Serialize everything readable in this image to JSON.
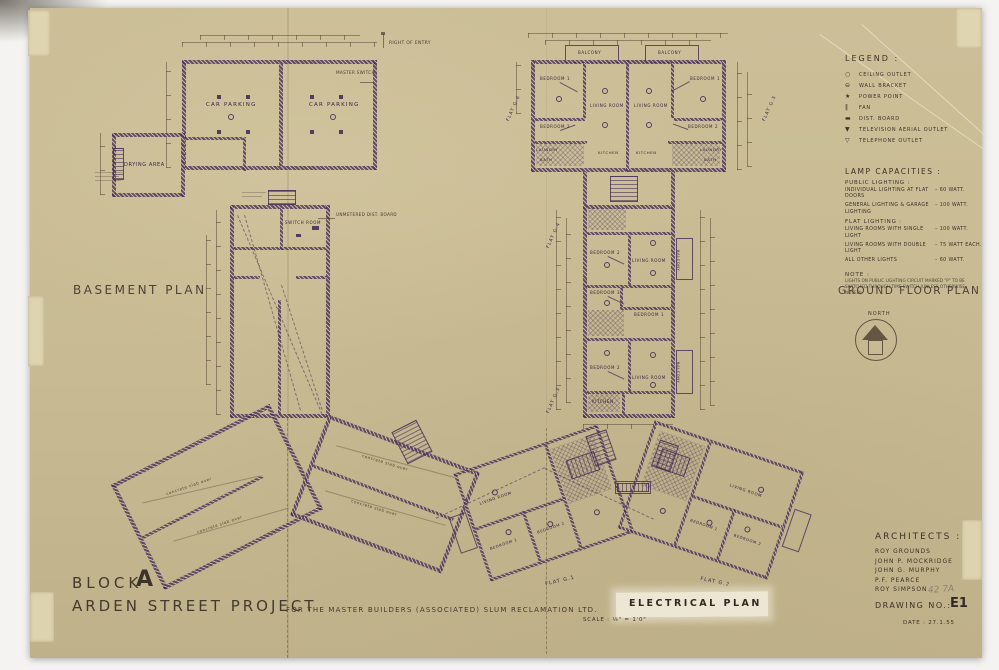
{
  "titles": {
    "basement": "BASEMENT PLAN",
    "ground": "GROUND FLOOR PLAN",
    "north": "NORTH"
  },
  "legend": {
    "title": "LEGEND :",
    "items": [
      {
        "name": "ceiling-outlet",
        "glyph": "○",
        "label": "CEILING OUTLET"
      },
      {
        "name": "wall-bracket",
        "glyph": "⊖",
        "label": "WALL BRACKET"
      },
      {
        "name": "power-point",
        "glyph": "★",
        "label": "POWER POINT"
      },
      {
        "name": "fan",
        "glyph": "‖",
        "label": "FAN"
      },
      {
        "name": "dist-board",
        "glyph": "▬",
        "label": "DIST. BOARD"
      },
      {
        "name": "television-aerial-outlet",
        "glyph": "▼",
        "label": "TELEVISION AERIAL OUTLET"
      },
      {
        "name": "telephone-outlet",
        "glyph": "▽",
        "label": "TELEPHONE OUTLET"
      }
    ]
  },
  "lamp_capacities": {
    "title": "LAMP CAPACITIES :",
    "public_heading": "PUBLIC LIGHTING :",
    "rows_public": [
      {
        "label": "INDIVIDUAL LIGHTING AT FLAT DOORS",
        "value": "–  60 WATT."
      },
      {
        "label": "GENERAL LIGHTING & GARAGE LIGHTING",
        "value": "–  100 WATT."
      }
    ],
    "flat_heading": "FLAT LIGHTING :",
    "rows_flat": [
      {
        "label": "LIVING ROOMS WITH SINGLE LIGHT",
        "value": "–  100 WATT."
      },
      {
        "label": "LIVING ROOMS WITH DOUBLE LIGHT",
        "value": "–  75 WATT EACH."
      },
      {
        "label": "ALL OTHER LIGHTS",
        "value": "–  60 WATT."
      }
    ],
    "note_title": "NOTE :",
    "note_text": "LIGHTS ON PUBLIC LIGHTING CIRCUIT MARKED \"P\" TO BE SWITCHED THROUGH TIME SWITCH (UNLESS OTHERWISE NOTED)"
  },
  "rooms": {
    "car_parking": "CAR PARKING",
    "drying_area": "DRYING AREA",
    "switch_room": "SWITCH ROOM",
    "living": "LIVING ROOM",
    "bedroom1": "BEDROOM 1",
    "bedroom2": "BEDROOM 2",
    "bedroom3": "BEDROOM 3",
    "kitchen": "KITCHEN",
    "laundry": "LAUNDRY",
    "bath": "BATH",
    "balcony": "BALCONY"
  },
  "flats": {
    "g1": "FLAT G.1",
    "g2": "FLAT G.2",
    "g3": "FLAT G.3",
    "g4": "FLAT G.4",
    "g5": "FLAT G.5",
    "g6": "FLAT G.6"
  },
  "annotations": {
    "master_switch": "MASTER SWITCH",
    "unmetered_board": "UNMETERED DIST. BOARD",
    "right_of_entry": "RIGHT OF ENTRY",
    "concrete_slab": "concrete slab over",
    "pencil_note": "42 7A"
  },
  "architects": {
    "title": "ARCHITECTS :",
    "names": [
      "ROY GROUNDS",
      "JOHN P. MOCKRIDGE",
      "JOHN G. MURPHY",
      "P.F. PEARCE",
      "ROY SIMPSON"
    ]
  },
  "title_block": {
    "block_word": "BLOCK",
    "block_letter": "A",
    "project": "ARDEN STREET PROJECT",
    "client": "FOR THE MASTER BUILDERS (ASSOCIATED) SLUM RECLAMATION LTD.",
    "plan_name": "ELECTRICAL PLAN",
    "scale": "SCALE : ⅛\" = 1'0\"",
    "drawing_no_label": "DRAWING NO.:",
    "drawing_no": "E1",
    "date": "DATE : 27.1.55"
  },
  "colors": {
    "paper": "#c8bb93",
    "plan_ink": "#462e56",
    "text_ink": "#3a3126",
    "highlight_patch": "#f0e9d8"
  }
}
